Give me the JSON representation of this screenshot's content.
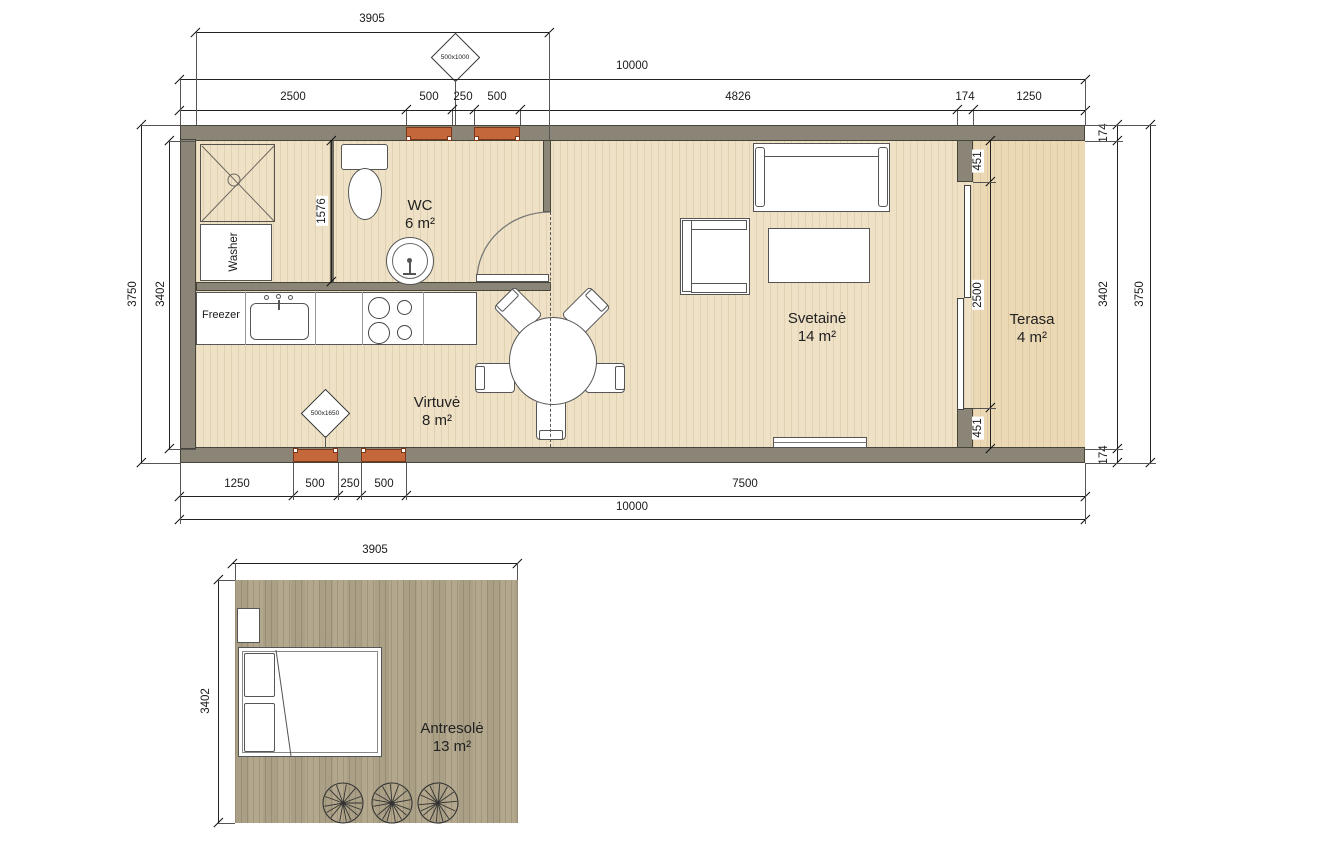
{
  "main": {
    "labels": {
      "wc": {
        "name": "WC",
        "area": "6 m²"
      },
      "kitchen": {
        "name": "Virtuvė",
        "area": "8 m²"
      },
      "living": {
        "name": "Svetainė",
        "area": "14 m²"
      },
      "terrace": {
        "name": "Terasa",
        "area": "4 m²"
      },
      "washer": "Washer",
      "freezer": "Freezer"
    },
    "markers": {
      "top": "500x1000",
      "bottom": "500x1650"
    },
    "dims": {
      "top_width": "3905",
      "top_overall": "10000",
      "top_chain": [
        "2500",
        "500",
        "250",
        "500",
        "4826",
        "174",
        "1250"
      ],
      "left_outer": "3750",
      "left_inner": "3402",
      "bath": "1576",
      "terrace_chain": [
        "451",
        "2500",
        "451"
      ],
      "right_chain": [
        "174",
        "3402",
        "174"
      ],
      "right_outer": "3750",
      "bottom_chain": [
        "1250",
        "500",
        "250",
        "500",
        "7500"
      ],
      "bottom_overall": "10000"
    },
    "colors": {
      "wall": "#8b8577",
      "floor": "#eee1c6",
      "terrace_floor": "#ebd8b4",
      "window": "#c4673a"
    }
  },
  "loft": {
    "label": {
      "name": "Antresolė",
      "area": "13 m²"
    },
    "dims": {
      "width": "3905",
      "height": "3402"
    },
    "colors": {
      "floor": "#b3a88d"
    }
  }
}
